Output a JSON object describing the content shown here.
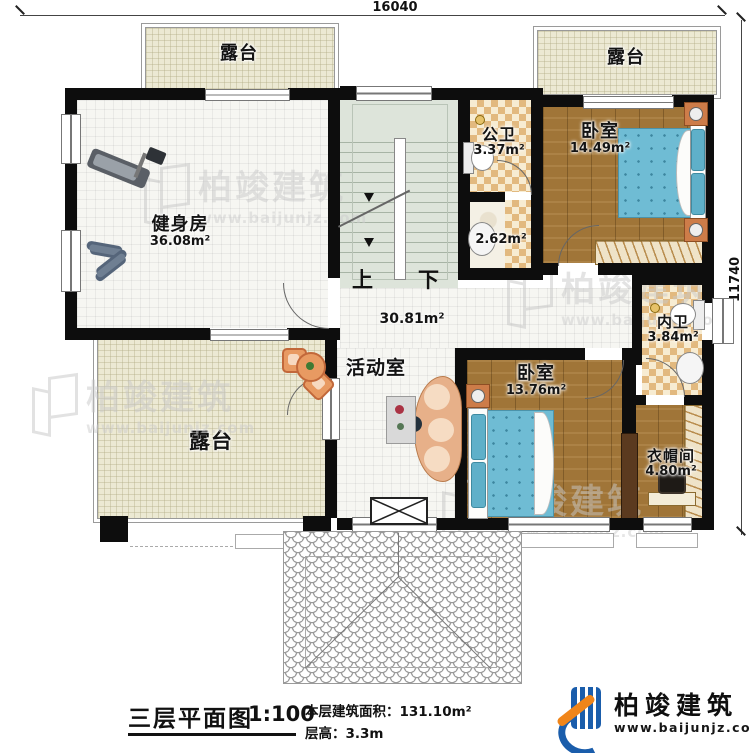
{
  "dimensions": {
    "width_top": "16040",
    "height_right": "11740"
  },
  "rooms": {
    "terrace_top_left": {
      "label": "露台"
    },
    "terrace_top_right": {
      "label": "露台"
    },
    "terrace_bottom": {
      "label": "露台"
    },
    "gym": {
      "label": "健身房",
      "area": "36.08m²"
    },
    "public_bath": {
      "label": "公卫",
      "area": "3.37m²"
    },
    "shower": {
      "area": "2.62m²"
    },
    "bedroom_top": {
      "label": "卧室",
      "area": "14.49m²"
    },
    "inner_bath": {
      "label": "内卫",
      "area": "3.84m²"
    },
    "activity": {
      "label": "活动室",
      "area": "30.81m²"
    },
    "bedroom_bottom": {
      "label": "卧室",
      "area": "13.76m²"
    },
    "cloakroom": {
      "label": "衣帽间",
      "area": "4.80m²"
    },
    "stairs": {
      "up": "上",
      "down": "下"
    }
  },
  "footer": {
    "title": "三层平面图",
    "scale": "1:100",
    "area_label": "本层建筑面积：",
    "area_value": "131.10m²",
    "floor_height_label": "层高：",
    "floor_height_value": "3.3m"
  },
  "brand": {
    "name": "柏竣建筑",
    "website": "www.baijunjz.com"
  },
  "watermark": {
    "name": "柏竣建筑",
    "website": "www.baijunjz.com"
  }
}
